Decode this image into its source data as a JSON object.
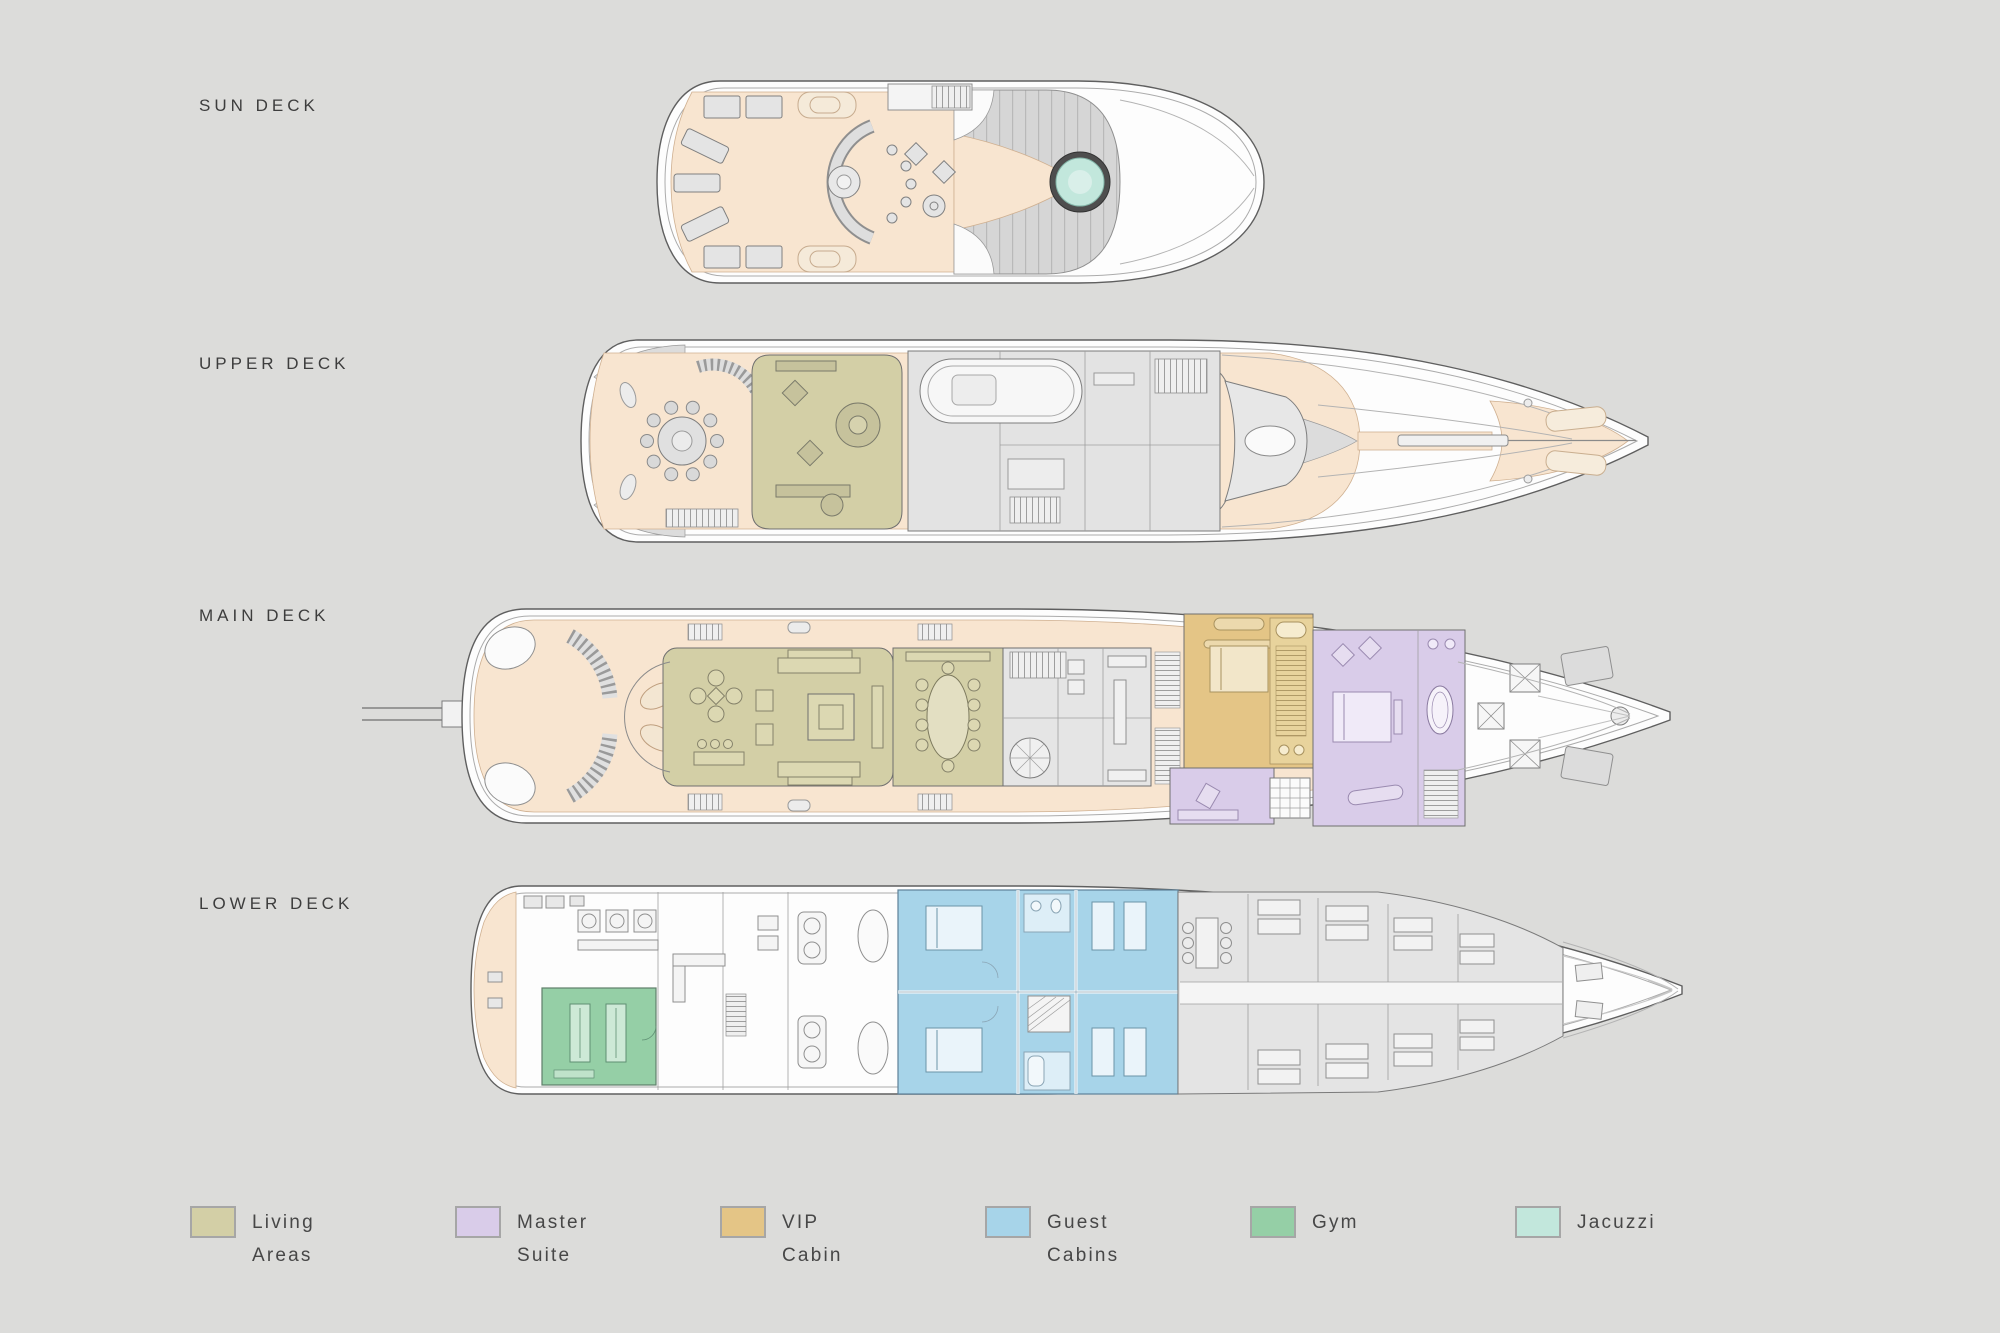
{
  "page": {
    "background": "#dcdcda"
  },
  "decks": [
    {
      "key": "sun",
      "label": "SUN DECK"
    },
    {
      "key": "upper",
      "label": "UPPER DECK"
    },
    {
      "key": "main",
      "label": "MAIN DECK"
    },
    {
      "key": "lower",
      "label": "LOWER DECK"
    }
  ],
  "legend": {
    "items": [
      {
        "key": "living",
        "label_line1": "Living",
        "label_line2": "Areas",
        "color": "#d3cfa6"
      },
      {
        "key": "master",
        "label_line1": "Master",
        "label_line2": "Suite",
        "color": "#d9cce9"
      },
      {
        "key": "vip",
        "label_line1": "VIP",
        "label_line2": "Cabin",
        "color": "#e4c586"
      },
      {
        "key": "guest",
        "label_line1": "Guest",
        "label_line2": "Cabins",
        "color": "#a7d4e9"
      },
      {
        "key": "gym",
        "label_line1": "Gym",
        "label_line2": "",
        "color": "#95cfa6"
      },
      {
        "key": "jacuzzi",
        "label_line1": "Jacuzzi",
        "label_line2": "",
        "color": "#c2e7dc"
      }
    ]
  }
}
